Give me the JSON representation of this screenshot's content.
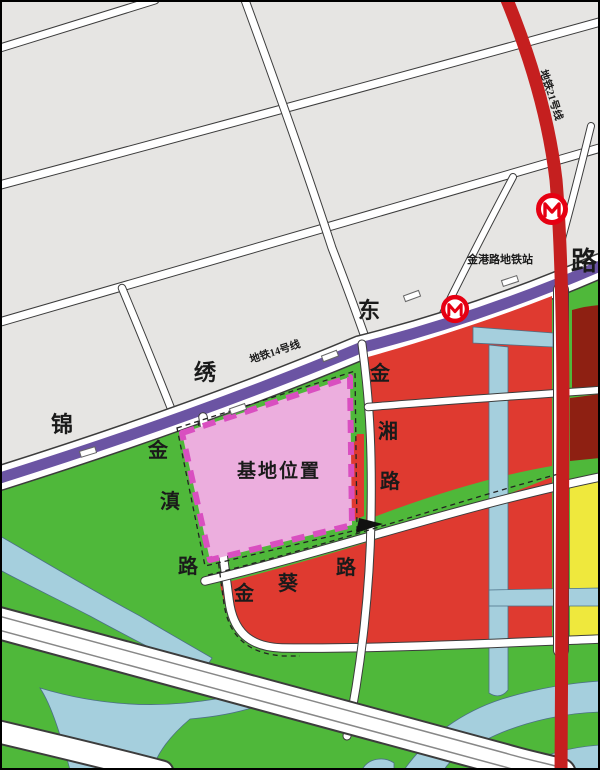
{
  "map": {
    "site": {
      "label": "基地位置"
    },
    "metro": {
      "line21_label": "地铁21号线",
      "line14_label": "地铁14号线",
      "station_label": "金港路地铁站"
    },
    "roads": {
      "jinxiu_dong_lu": [
        "锦",
        "绣",
        "东",
        "路"
      ],
      "jindian_lu": [
        "金",
        "滇",
        "路"
      ],
      "jinxiang_lu": [
        "金",
        "湘",
        "路"
      ],
      "jinkui_lu": [
        "金",
        "葵",
        "路"
      ]
    },
    "colors": {
      "site_fill": "#ecaede",
      "site_border": "#d94fc0",
      "zone_red": "#df3a30",
      "zone_dark_red": "#8e2012",
      "zone_green": "#4fb83a",
      "zone_yellow": "#efe83d",
      "water_blue": "#a5cfdd",
      "block_grey": "#e6e5e3",
      "metro14_purple": "#6b54a3",
      "metro21_red": "#c51f1f",
      "metro_logo_red": "#e60012"
    }
  }
}
